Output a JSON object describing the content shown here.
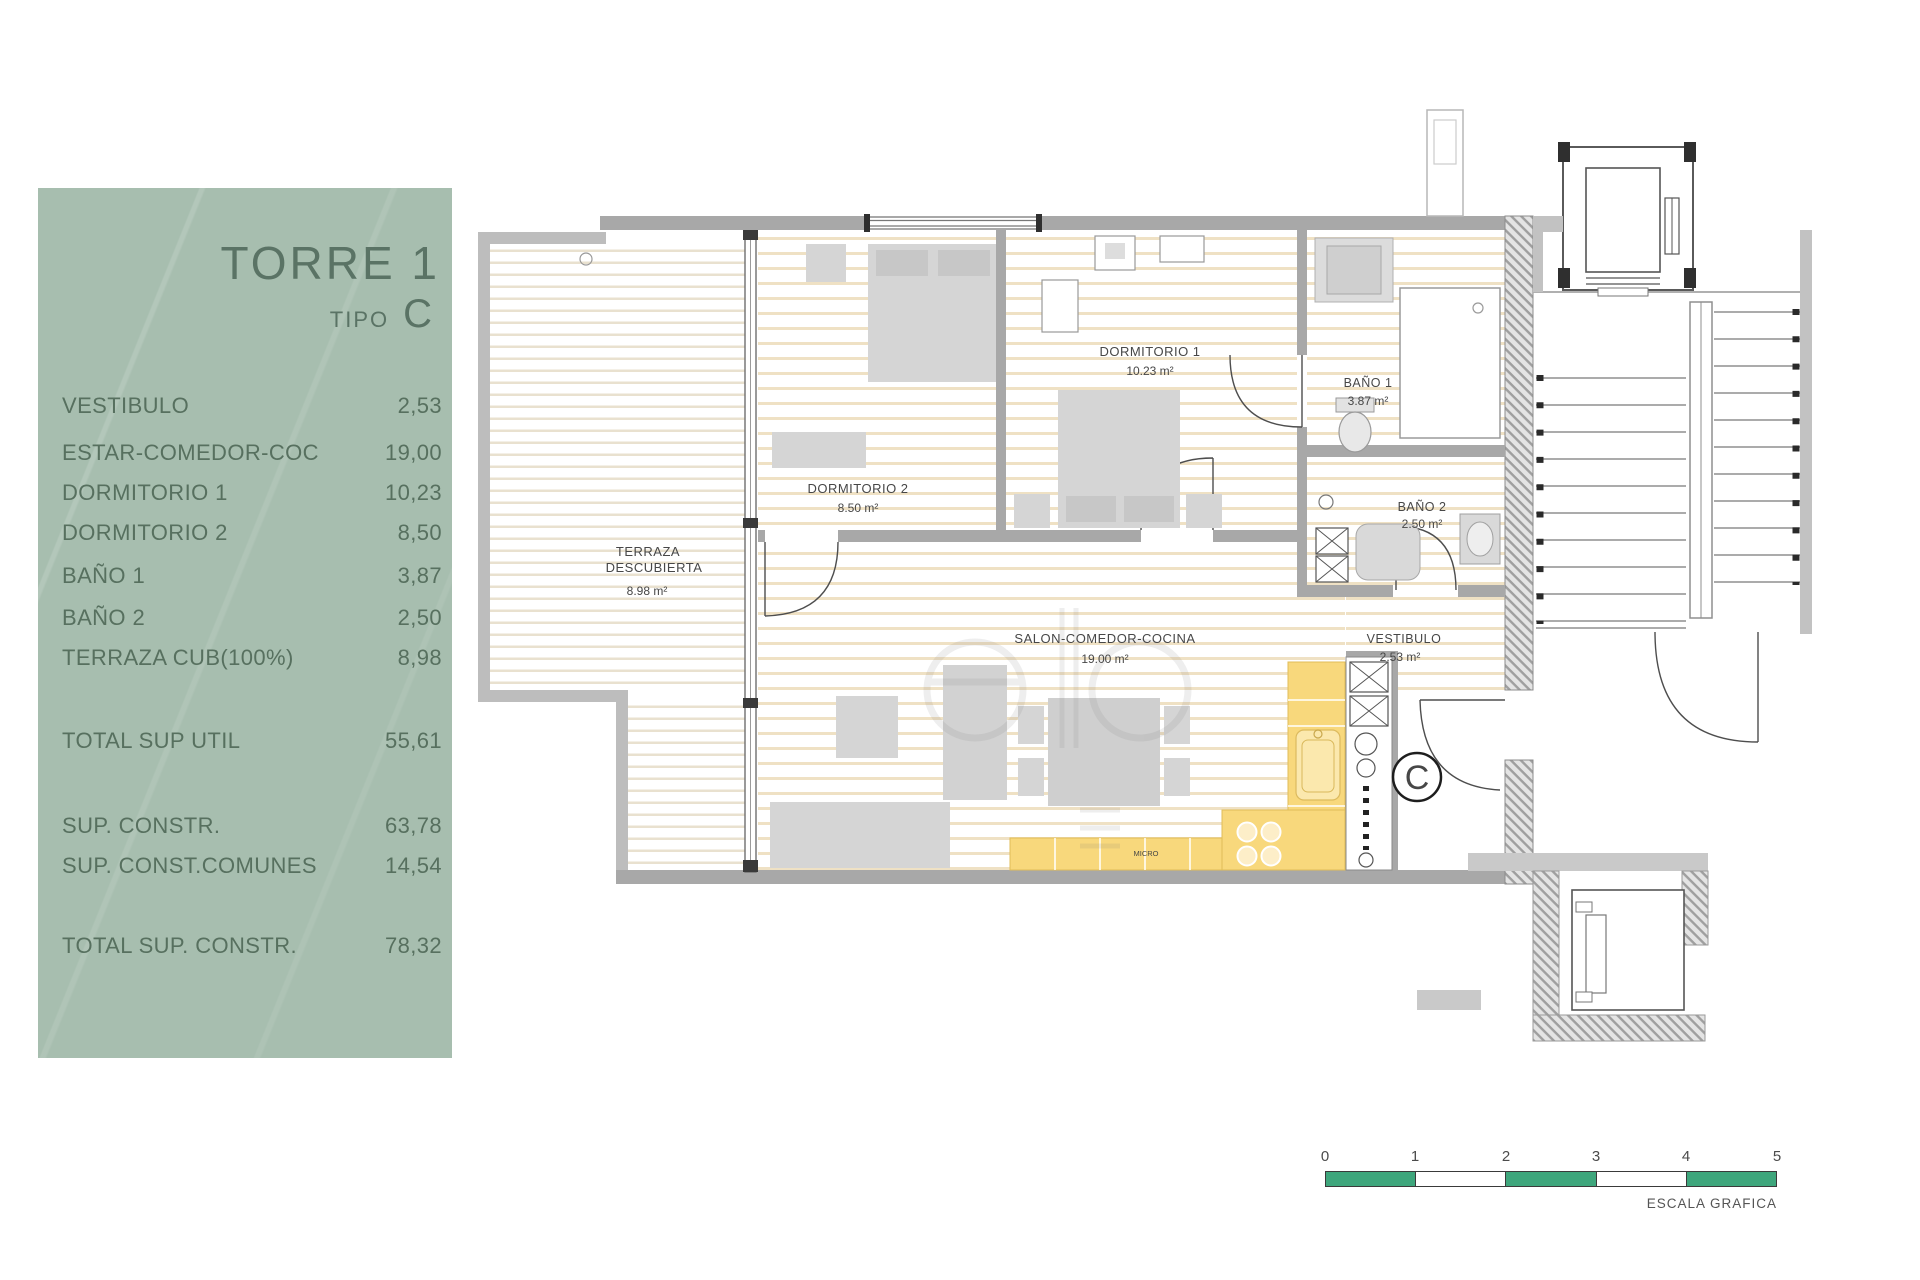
{
  "panel": {
    "title": "TORRE 1",
    "subtitle_label": "TIPO",
    "subtitle_value": "C",
    "bg_color": "#a7beaf",
    "text_color": "#57705f",
    "rows": [
      {
        "label": "VESTIBULO",
        "value": "2,53"
      },
      {
        "label": "ESTAR-COMEDOR-COC",
        "value": "19,00"
      },
      {
        "label": "DORMITORIO 1",
        "value": "10,23"
      },
      {
        "label": "DORMITORIO 2",
        "value": "8,50"
      },
      {
        "label": "BAÑO 1",
        "value": "3,87"
      },
      {
        "label": "BAÑO 2",
        "value": "2,50"
      },
      {
        "label": "TERRAZA CUB(100%)",
        "value": "8,98"
      },
      {
        "label": "TOTAL SUP UTIL",
        "value": "55,61"
      },
      {
        "label": "SUP. CONSTR.",
        "value": "63,78"
      },
      {
        "label": "SUP. CONST.COMUNES",
        "value": "14,54"
      },
      {
        "label": "TOTAL SUP. CONSTR.",
        "value": "78,32"
      }
    ]
  },
  "plan": {
    "rooms": {
      "terraza": {
        "name1": "TERRAZA",
        "name2": "DESCUBIERTA",
        "area": "8.98 m²"
      },
      "dormitorio2": {
        "name": "DORMITORIO 2",
        "area": "8.50 m²"
      },
      "dormitorio1": {
        "name": "DORMITORIO 1",
        "area": "10.23 m²"
      },
      "bano1": {
        "name": "BAÑO 1",
        "area": "3.87 m²"
      },
      "bano2": {
        "name": "BAÑO 2",
        "area": "2.50 m²"
      },
      "salon": {
        "name": "SALON-COMEDOR-COCINA",
        "area": "19.00 m²"
      },
      "vestibulo": {
        "name": "VESTIBULO",
        "area": "2.53 m²"
      }
    },
    "unit_marker": "C",
    "micro_label": "MICRO",
    "kitchen_color": "#f8d87c"
  },
  "scale": {
    "ticks": [
      "0",
      "1",
      "2",
      "3",
      "4",
      "5"
    ],
    "label": "ESCALA GRAFICA",
    "green": "#3ea67c"
  }
}
